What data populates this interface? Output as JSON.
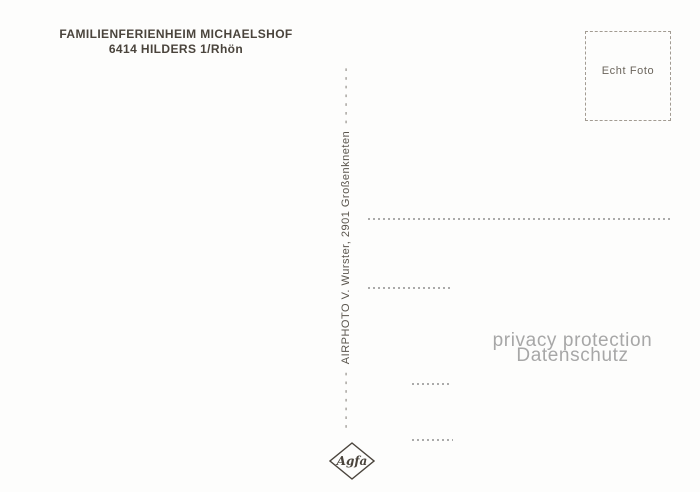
{
  "postcard": {
    "header": {
      "line1": "FAMILIENFERIENHEIM MICHAELSHOF",
      "line2": "6414 HILDERS 1/Rhön"
    },
    "stamp_box": {
      "label": "Echt Foto"
    },
    "publisher": {
      "dashes_left": "- - - - - - -",
      "text": "AIRPHOTO V. Wurster, 2901 Großenkneten",
      "dashes_right": "- - - - - - -"
    },
    "watermark": {
      "line1": "privacy protection",
      "line2": "Datenschutz"
    },
    "logo": {
      "brand": "Agfa"
    },
    "colors": {
      "background": "#fdfdfc",
      "ink": "#4a443c",
      "stamp_border": "#a29b92",
      "address_line": "#9c9c9c",
      "watermark_gray": "#a7a7a7"
    }
  }
}
